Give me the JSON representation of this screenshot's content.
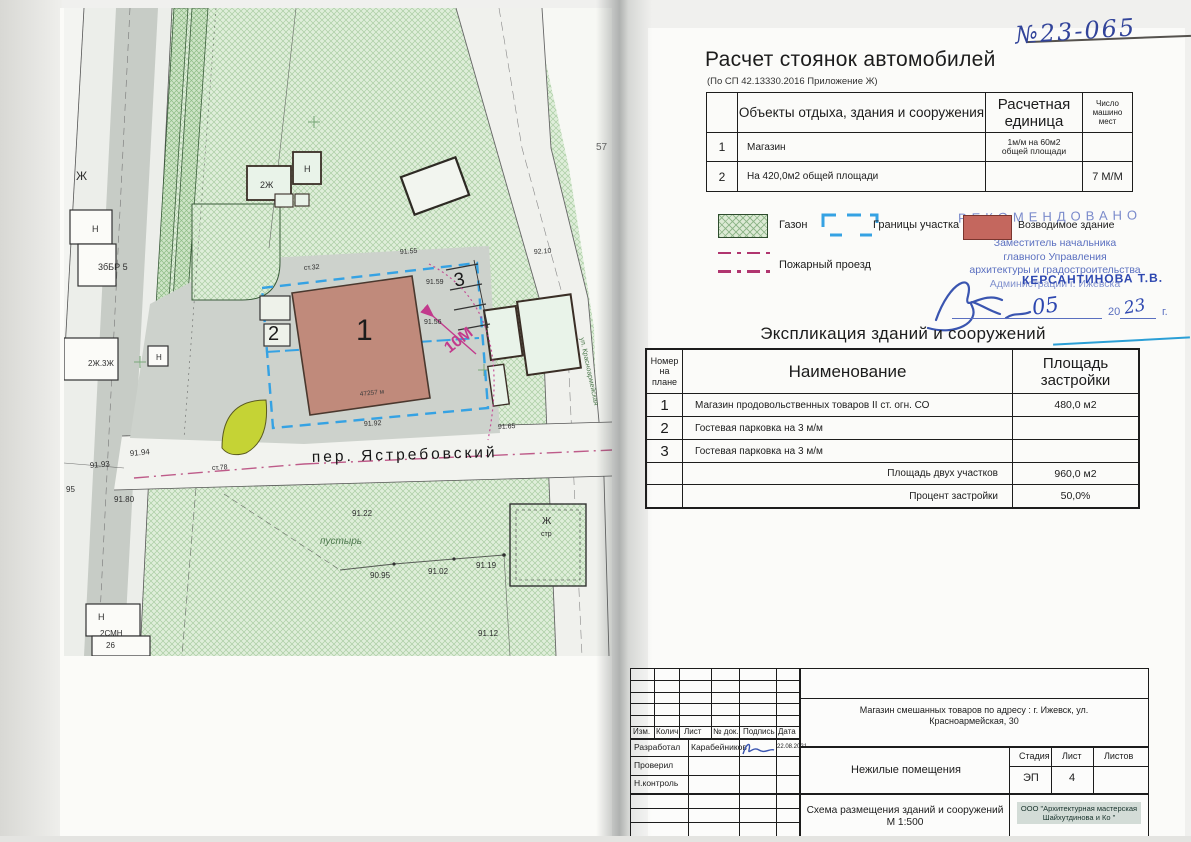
{
  "doc_number_handwritten": "№23-065",
  "parking": {
    "title": "Расчет стоянок автомобилей",
    "subtitle": "(По СП 42.13330.2016 Приложение Ж)",
    "col_object": "Объекты отдыха, здания и сооружения",
    "col_unit1": "Расчетная",
    "col_unit2": "единица",
    "col_count1": "Число",
    "col_count2": "машино",
    "col_count3": "мест",
    "rows": [
      {
        "num": "1",
        "object": "Магазин",
        "unit1": "1м/м на 60м2",
        "unit2": "общей площади",
        "count": ""
      },
      {
        "num": "2",
        "object": "На 420,0м2 общей площади",
        "unit1": "",
        "unit2": "",
        "count": "7 М/М"
      }
    ]
  },
  "legend": {
    "lawn": "Газон",
    "boundary": "Границы участка",
    "building": "Возводимое здание",
    "fire": "Пожарный проезд"
  },
  "stamp": {
    "recommended": "РЕКОМЕНДОВАНО",
    "line1": "Заместитель начальника",
    "line2": "главного Управления",
    "line3": "архитектуры и градостроительства",
    "line4": "Администрации г. Ижевска",
    "name_overstamp": "КЕРСАНТИНОВА Т.В.",
    "date_month": "05",
    "year_prefix": "20",
    "year_hand": "23",
    "year_suffix": "г."
  },
  "explication": {
    "title": "Экспликация зданий и сооружений",
    "col_num1": "Номер",
    "col_num2": "на",
    "col_num3": "плане",
    "col_name": "Наименование",
    "col_area1": "Площадь",
    "col_area2": "застройки",
    "rows": [
      {
        "num": "1",
        "name": "Магазин продовольственных товаров II ст. огн. СО",
        "area": "480,0 м2"
      },
      {
        "num": "2",
        "name": "Гостевая парковка на  3 м/м",
        "area": ""
      },
      {
        "num": "3",
        "name": "Гостевая парковка на  3 м/м",
        "area": ""
      }
    ],
    "total_label": "Площадь двух участков",
    "total_value": "960,0 м2",
    "percent_label": "Процент застройки",
    "percent_value": "50,0%"
  },
  "titleblock": {
    "col_izm": "Изм.",
    "col_kolich": "Колич.",
    "col_list": "Лист",
    "col_ndok": "№ док.",
    "col_podpis": "Подпись",
    "col_data": "Дата",
    "dev_label": "Разработал",
    "dev_name": "Карабейников",
    "dev_date": "22.08.2021",
    "check_label": "Проверил",
    "ncontrol_label": "Н.контроль",
    "project_line1": "Магазин смешанных товаров по адресу : г. Ижевск, ул.",
    "project_line2": "Красноармейская, 30",
    "object_name": "Нежилые помещения",
    "stage_label": "Стадия",
    "sheet_label": "Лист",
    "sheets_label": "Листов",
    "stage_value": "ЭП",
    "sheet_value": "4",
    "sheets_value": "",
    "drawing_name": "Схема размещения зданий и сооружений М 1:500",
    "company_line1": "ООО \"Архитектурная мастерская",
    "company_line2": "Шайхутдинова и Ко \""
  },
  "map": {
    "street": "пер. Ястребовский",
    "street_vertical": "ул. Красноармейская",
    "building_number": "1",
    "parking2_number": "2",
    "parking3_number": "3",
    "dimension": "10М",
    "area_note": "47257 м",
    "labels": [
      {
        "t": "Ж",
        "x": 12,
        "y": 172,
        "s": 12
      },
      {
        "t": "Н",
        "x": 28,
        "y": 224,
        "s": 9
      },
      {
        "t": "3бБР 5",
        "x": 34,
        "y": 262,
        "s": 9
      },
      {
        "t": "2Ж.3Ж",
        "x": 24,
        "y": 358,
        "s": 8
      },
      {
        "t": "Н",
        "x": 92,
        "y": 352,
        "s": 8
      },
      {
        "t": "Н",
        "x": 34,
        "y": 612,
        "s": 9
      },
      {
        "t": "2СМН",
        "x": 36,
        "y": 628,
        "s": 8
      },
      {
        "t": "26",
        "x": 42,
        "y": 640,
        "s": 8
      },
      {
        "t": "2Ж",
        "x": 196,
        "y": 180,
        "s": 9
      },
      {
        "t": "Н",
        "x": 240,
        "y": 164,
        "s": 9
      },
      {
        "t": "57",
        "x": 532,
        "y": 142,
        "s": 10,
        "c": "#666666"
      },
      {
        "t": "92.10",
        "x": 470,
        "y": 246,
        "s": 7,
        "r": -4
      },
      {
        "t": "91.55",
        "x": 336,
        "y": 246,
        "s": 7,
        "r": -4
      },
      {
        "t": "ст.32",
        "x": 240,
        "y": 262,
        "s": 7,
        "r": -4
      },
      {
        "t": "91.59",
        "x": 362,
        "y": 276,
        "s": 7
      },
      {
        "t": "91.56",
        "x": 360,
        "y": 316,
        "s": 7
      },
      {
        "t": "91.92",
        "x": 300,
        "y": 418,
        "s": 7,
        "r": -3
      },
      {
        "t": "91.65",
        "x": 434,
        "y": 421,
        "s": 7,
        "r": -3
      },
      {
        "t": "91.94",
        "x": 66,
        "y": 448,
        "s": 8,
        "r": -5
      },
      {
        "t": "91.93",
        "x": 26,
        "y": 460,
        "s": 8,
        "r": -5
      },
      {
        "t": "ст.78",
        "x": 148,
        "y": 462,
        "s": 7,
        "r": -3
      },
      {
        "t": "91.80",
        "x": 50,
        "y": 494,
        "s": 8
      },
      {
        "t": "95",
        "x": 2,
        "y": 484,
        "s": 8
      },
      {
        "t": "91.22",
        "x": 288,
        "y": 508,
        "s": 8
      },
      {
        "t": "пустырь",
        "x": 256,
        "y": 536,
        "s": 10,
        "c": "#4f7a4f",
        "i": true
      },
      {
        "t": "90.95",
        "x": 306,
        "y": 570,
        "s": 8
      },
      {
        "t": "91.02",
        "x": 364,
        "y": 566,
        "s": 8
      },
      {
        "t": "91.19",
        "x": 412,
        "y": 560,
        "s": 8
      },
      {
        "t": "91.12",
        "x": 414,
        "y": 628,
        "s": 8
      },
      {
        "t": "Ж",
        "x": 478,
        "y": 516,
        "s": 10
      },
      {
        "t": "стр",
        "x": 477,
        "y": 528,
        "s": 7
      }
    ]
  },
  "colors": {
    "building_fill": "#c08a7b",
    "boundary_blue": "#35a2e3",
    "magenta": "#c23a8c",
    "lawn_green": "#dcead5",
    "yellow_blob": "#c5d335",
    "stamp_blue": "#5a6fc0",
    "ink_blue": "#32449a"
  }
}
